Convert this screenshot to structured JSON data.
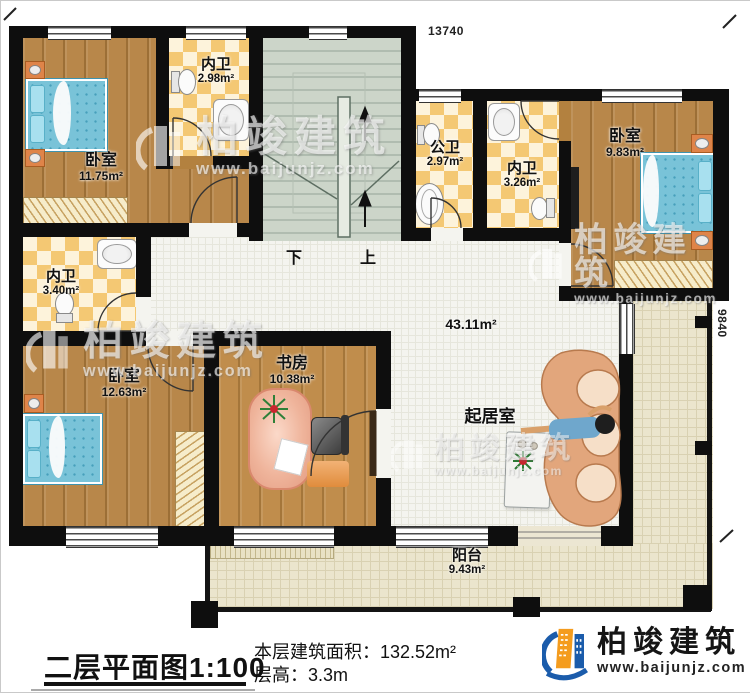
{
  "plan": {
    "dim_top": "13740",
    "dim_right": "9840",
    "rooms": {
      "bedroom_tl": {
        "name": "卧室",
        "area": "11.75m²"
      },
      "ensuite_top": {
        "name": "内卫",
        "area": "2.98m²"
      },
      "public_bath": {
        "name": "公卫",
        "area": "2.97m²"
      },
      "ensuite_tr": {
        "name": "内卫",
        "area": "3.26m²"
      },
      "bedroom_tr": {
        "name": "卧室",
        "area": "9.83m²"
      },
      "ensuite_left": {
        "name": "内卫",
        "area": "3.40m²"
      },
      "bedroom_bl": {
        "name": "卧室",
        "area": "12.63m²"
      },
      "study": {
        "name": "书房",
        "area": "10.38m²"
      },
      "living": {
        "name": "起居室",
        "area": "43.11m²"
      },
      "balcony": {
        "name": "阳台",
        "area": "9.43m²"
      }
    },
    "stairs": {
      "down": "下",
      "up": "上"
    }
  },
  "titleblock": {
    "title": "二层平面图",
    "scale": "1:100",
    "area_label": "本层建筑面积：",
    "area_value": "132.52m²",
    "height_label": "层高：",
    "height_value": "3.3m"
  },
  "branding": {
    "company": "柏竣建筑",
    "website": "www.baijunjz.com"
  },
  "watermark": {
    "company": "柏竣建筑",
    "website": "www.baijunjz.com"
  }
}
